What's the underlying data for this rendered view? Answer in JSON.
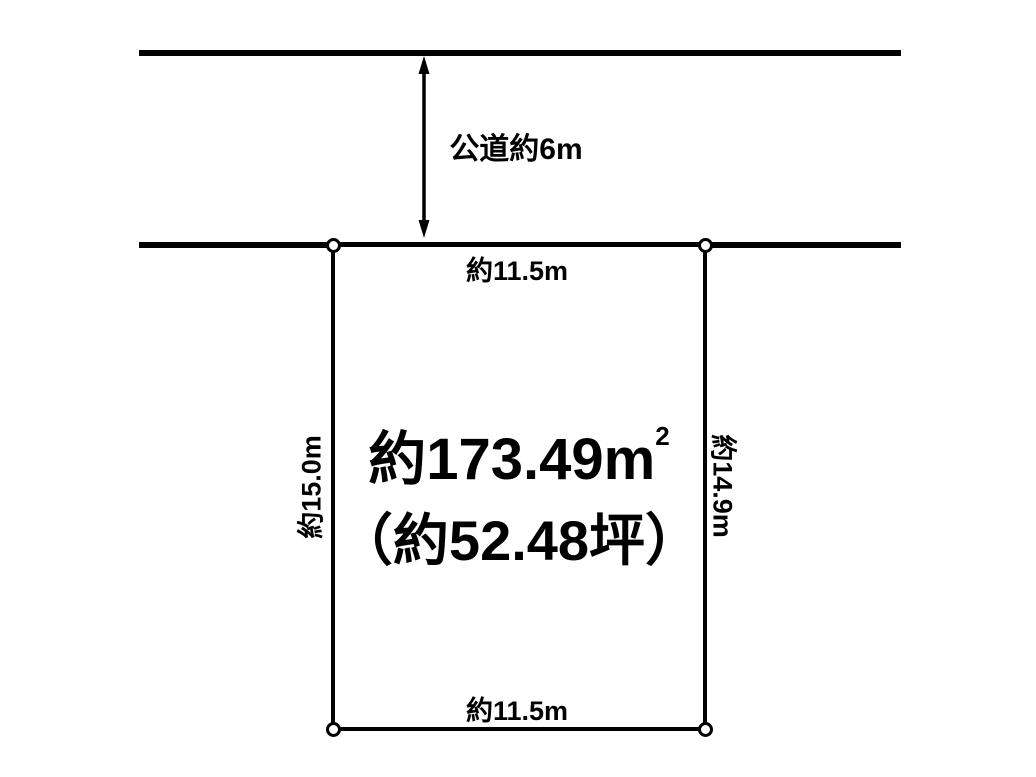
{
  "road": {
    "label": "公道約6m"
  },
  "plot": {
    "top_width_label": "約11.5m",
    "bottom_width_label": "約11.5m",
    "left_length_label": "約15.0m",
    "right_length_label": "約14.9m",
    "area_sqm_text": "約173.49m",
    "area_sqm_sup": "2",
    "area_tsubo_text": "（約52.48坪）"
  },
  "colors": {
    "ink": "#000000",
    "background": "#ffffff"
  }
}
